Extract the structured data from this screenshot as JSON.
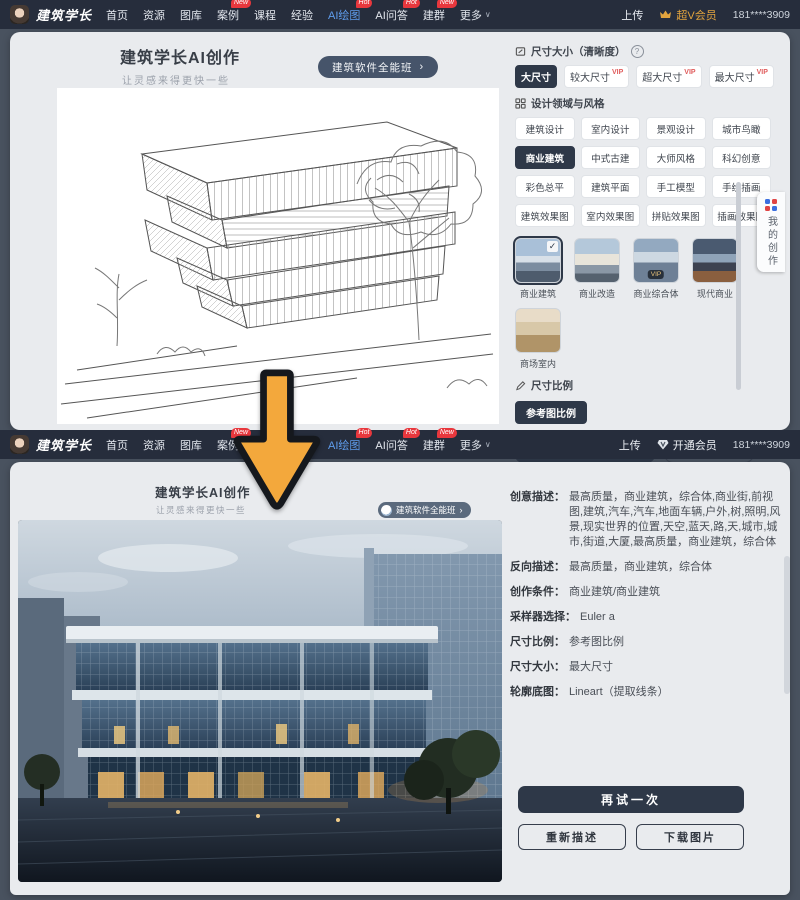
{
  "nav": {
    "logo": "建筑学长",
    "items": [
      {
        "label": "首页"
      },
      {
        "label": "资源"
      },
      {
        "label": "图库"
      },
      {
        "label": "案例",
        "badge": "New"
      },
      {
        "label": "课程"
      },
      {
        "label": "经验"
      },
      {
        "label": "AI绘图",
        "badge": "Hot",
        "active": true
      },
      {
        "label": "AI问答",
        "badge": "Hot"
      },
      {
        "label": "建群",
        "badge": "New"
      },
      {
        "label": "更多",
        "caret": "∨"
      }
    ],
    "upload": "上传",
    "member_top": "超V会员",
    "member_bottom": "开通会员",
    "phone": "181****3909"
  },
  "hero": {
    "title": "建筑学长AI创作",
    "subtitle": "让灵感来得更快一些",
    "course_button": "建筑软件全能班",
    "chevron": "›"
  },
  "panel": {
    "size_title": "尺寸大小（清晰度）",
    "help_icon": "?",
    "size_options": [
      {
        "label": "大尺寸",
        "selected": true
      },
      {
        "label": "较大尺寸",
        "vip": "VIP"
      },
      {
        "label": "超大尺寸",
        "vip": "VIP"
      },
      {
        "label": "最大尺寸",
        "vip": "VIP"
      }
    ],
    "style_title": "设计领域与风格",
    "style_options": [
      {
        "label": "建筑设计"
      },
      {
        "label": "室内设计"
      },
      {
        "label": "景观设计"
      },
      {
        "label": "城市鸟瞰"
      },
      {
        "label": "商业建筑",
        "selected": true
      },
      {
        "label": "中式古建"
      },
      {
        "label": "大师风格"
      },
      {
        "label": "科幻创意"
      },
      {
        "label": "彩色总平"
      },
      {
        "label": "建筑平面"
      },
      {
        "label": "手工模型"
      },
      {
        "label": "手绘插画"
      },
      {
        "label": "建筑效果图"
      },
      {
        "label": "室内效果图"
      },
      {
        "label": "拼贴效果图"
      },
      {
        "label": "插画效果图"
      }
    ],
    "thumbs": [
      {
        "label": "商业建筑",
        "checked": true
      },
      {
        "label": "商业改造"
      },
      {
        "label": "商业综合体",
        "vip": "VIP"
      },
      {
        "label": "现代商业"
      },
      {
        "label": "商场室内"
      }
    ],
    "ratio_title": "尺寸比例",
    "ratio_selected": "参考图比例",
    "create_button": "开始创作",
    "count_button": "生成1张 ›"
  },
  "side_tab": {
    "label": "我的创作"
  },
  "result": {
    "fields": [
      {
        "label": "创意描述：",
        "value": "最高质量，商业建筑，综合体,商业街,前视图,建筑,汽车,汽车,地面车辆,户外,树,照明,风景,现实世界的位置,天空,蓝天,路,天,城市,城市,街道,大厦,最高质量，商业建筑，综合体"
      },
      {
        "label": "反向描述：",
        "value": "最高质量，商业建筑，综合体"
      },
      {
        "label": "创作条件：",
        "value": "商业建筑/商业建筑"
      },
      {
        "label": "采样器选择：",
        "value": "Euler a"
      },
      {
        "label": "尺寸比例：",
        "value": "参考图比例"
      },
      {
        "label": "尺寸大小：",
        "value": "最大尺寸"
      },
      {
        "label": "轮廓底图：",
        "value": "Lineart（提取线条）"
      }
    ],
    "retry_button": "再试一次",
    "redescribe_button": "重新描述",
    "download_button": "下载图片"
  },
  "colors": {
    "navbar": "#262d3c",
    "page_bg": "#49525f",
    "card_bg": "#e9ebee",
    "accent_dark": "#2e3848",
    "badge_red": "#e8373d",
    "vip_red": "#e05c5c",
    "active_blue": "#5f9ded",
    "member_gold": "#e2a43e",
    "arrow_yellow": "#f3a83c"
  }
}
